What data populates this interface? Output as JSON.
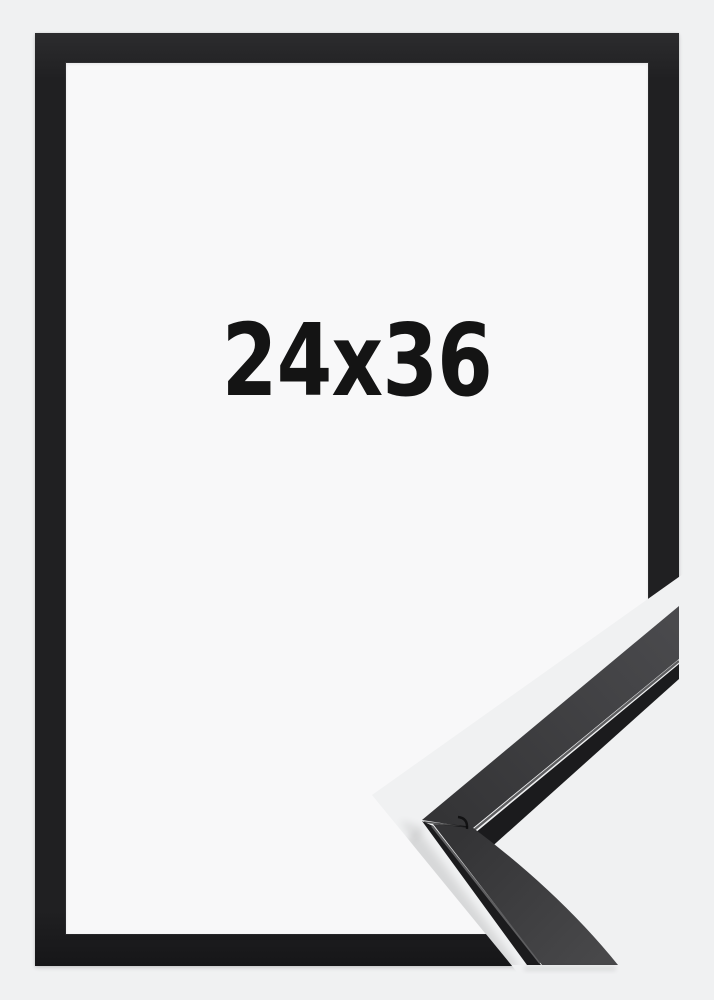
{
  "product": {
    "size_label": "24x36",
    "frame_color_name": "black"
  },
  "colors": {
    "bg": "#f0f1f2",
    "inner": "#f8f8f9",
    "frame": "#202022",
    "text": "#141414",
    "moulding_face": "#3d3d3f",
    "moulding_face_light": "#4a4a4d",
    "moulding_face_dark": "#323234",
    "moulding_side": "#1b1b1d",
    "moulding_highlight": "#5e5e60"
  },
  "icons": {
    "corner_detail": "mitered-frame-corner-closeup"
  }
}
